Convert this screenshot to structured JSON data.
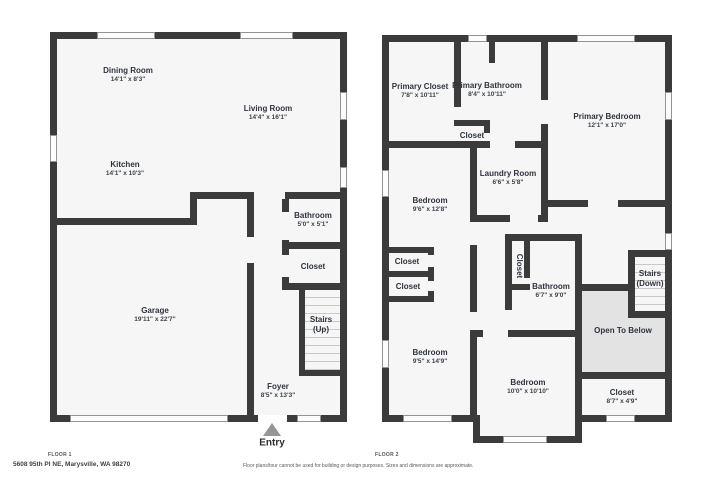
{
  "floor1": {
    "label": "FLOOR 1",
    "dining": {
      "name": "Dining Room",
      "dims": "14'1\" x 8'3\""
    },
    "living": {
      "name": "Living Room",
      "dims": "14'4\" x 16'1\""
    },
    "kitchen": {
      "name": "Kitchen",
      "dims": "14'1\" x 10'3\""
    },
    "bathroom": {
      "name": "Bathroom",
      "dims": "5'0\" x 5'1\""
    },
    "closet": {
      "name": "Closet"
    },
    "stairs": {
      "name": "Stairs",
      "dims": "(Up)"
    },
    "garage": {
      "name": "Garage",
      "dims": "19'11\" x 22'7\""
    },
    "foyer": {
      "name": "Foyer",
      "dims": "8'5\" x 13'3\""
    },
    "entry": "Entry"
  },
  "floor2": {
    "label": "FLOOR 2",
    "primary_closet": {
      "name": "Primary Closet",
      "dims": "7'8\" x 10'11\""
    },
    "primary_bathroom": {
      "name": "Primary Bathroom",
      "dims": "8'4\" x 10'11\""
    },
    "primary_bedroom": {
      "name": "Primary Bedroom",
      "dims": "12'1\" x 17'0\""
    },
    "hall_closet": {
      "name": "Closet"
    },
    "laundry": {
      "name": "Laundry Room",
      "dims": "6'6\" x 5'8\""
    },
    "bedroom_upper_left": {
      "name": "Bedroom",
      "dims": "9'6\" x 12'8\""
    },
    "closet_a": {
      "name": "Closet"
    },
    "closet_b": {
      "name": "Closet"
    },
    "closet_vertical": {
      "name": "Closet"
    },
    "bathroom": {
      "name": "Bathroom",
      "dims": "6'7\" x 9'0\""
    },
    "stairs": {
      "name": "Stairs",
      "dims": "(Down)"
    },
    "open_to_below": {
      "name": "Open To Below"
    },
    "bedroom_lower_left": {
      "name": "Bedroom",
      "dims": "9'5\" x 14'9\""
    },
    "bedroom_bottom": {
      "name": "Bedroom",
      "dims": "10'0\" x 10'10\""
    },
    "closet_right": {
      "name": "Closet",
      "dims": "8'7\" x 4'9\""
    }
  },
  "footer": {
    "address": "5608 95th Pl NE, Marysville, WA 98270",
    "disclaimer": "Floor plans/tour cannot be used for building or design purposes. Sizes and dimensions are approximate."
  },
  "colors": {
    "wall": "#3b3b3b",
    "room_fill": "#f6f6f6",
    "open_to_below_fill": "#e3e3e3",
    "entry_arrow": "#969696"
  }
}
